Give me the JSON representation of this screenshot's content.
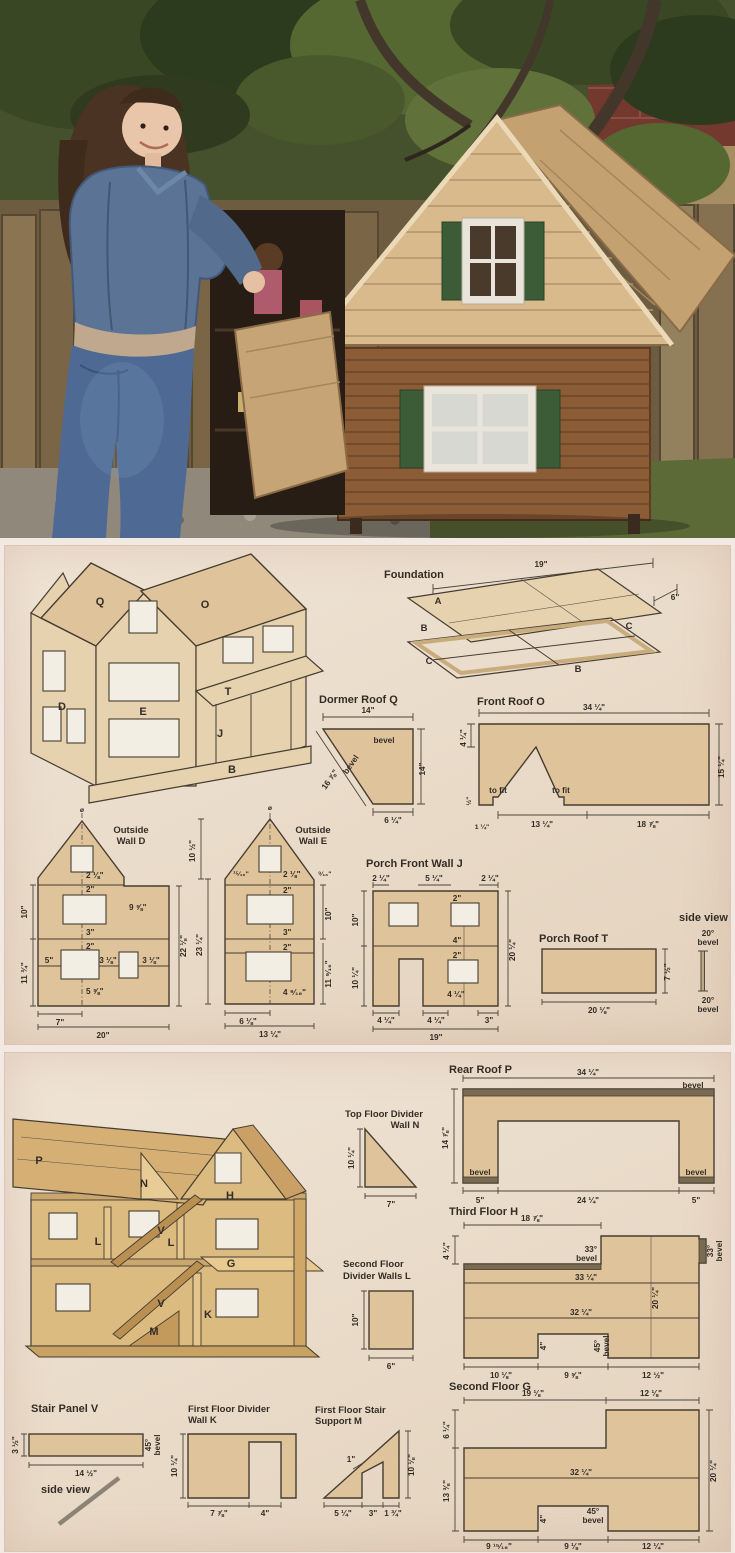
{
  "colors": {
    "wood": "#dfc49b",
    "outline": "#453d31",
    "panel_bg": "#eadcca",
    "roof_shingle": "#d8ba8c",
    "house_wood": "#8c5c37",
    "shutter_green": "#3c5c38",
    "denim": "#5b7495"
  },
  "middle": {
    "house": {
      "q": "Q",
      "o": "O",
      "d": "D",
      "e": "E",
      "t": "T",
      "j": "J",
      "b": "B"
    },
    "foundation": {
      "title": "Foundation",
      "a": "A",
      "b1": "B",
      "c1": "C",
      "c2": "C",
      "b2": "B",
      "w": "19\"",
      "d": "6\""
    },
    "dormer": {
      "title": "Dormer Roof Q",
      "top": "14\"",
      "bevel1": "bevel",
      "bevel2": "bevel",
      "diag": "16 ⅞\"",
      "right": "14\"",
      "bottom": "6 ¼\""
    },
    "front_roof": {
      "title": "Front Roof O",
      "top": "34 ¼\"",
      "left": "4 ¼\"",
      "right": "15 ¼\"",
      "tofit1": "to fit",
      "tofit2": "to fit",
      "half": "½\"",
      "oneq": "1 ¼\"",
      "b1": "13 ¼\"",
      "b2": "18 ⅞\""
    },
    "wall_d": {
      "title1": "Outside",
      "title2": "Wall D",
      "phi": "ø",
      "a1": "2 ⅛\"",
      "a2": "2\"",
      "a3": "9 ⅝\"",
      "a4": "3\"",
      "a5": "2\"",
      "a6": "5\"",
      "a7": "3 ⅛\"",
      "a8": "3 ⅛\"",
      "a9": "5 ⅝\"",
      "l1": "10\"",
      "l2": "11 ¾\"",
      "r1": "22 ⅛\"",
      "b1": "7\"",
      "b2": "20\""
    },
    "wall_e": {
      "title1": "Outside",
      "title2": "Wall E",
      "phi": "ø",
      "l1": "10 ½\"",
      "a1": "¹⁵⁄₁₆\"",
      "a2": "2 ⅛\"",
      "a3": "⁹⁄₁₆\"",
      "a4": "2\"",
      "r1": "10\"",
      "a5": "3\"",
      "a6": "2\"",
      "r2": "11 ⁹⁄₁₆\"",
      "a7": "4 ⁹⁄₁₆\"",
      "l2": "23 ¼\"",
      "b1": "6 ⅛\"",
      "b2": "13 ¼\""
    },
    "wall_j": {
      "title": "Porch Front Wall J",
      "t1": "2 ¼\"",
      "t2": "5 ¼\"",
      "t3": "2 ¼\"",
      "l1": "10\"",
      "l2": "10 ¼\"",
      "r1": "20 ¼\"",
      "a1": "2\"",
      "a2": "4\"",
      "a3": "2\"",
      "a4": "4 ¼\"",
      "b1": "4 ¼\"",
      "b2": "4 ¼\"",
      "b3": "3\"",
      "b4": "19\""
    },
    "porch_roof": {
      "title": "Porch Roof T",
      "b": "20 ⅛\"",
      "r": "7 ½\""
    },
    "side_view": {
      "title": "side view",
      "top1": "20°",
      "top2": "bevel",
      "bot1": "20°",
      "bot2": "bevel"
    }
  },
  "bottom": {
    "house": {
      "p": "P",
      "n": "N",
      "h": "H",
      "l1": "L",
      "l2": "L",
      "g": "G",
      "v1": "V",
      "v2": "V",
      "k": "K",
      "m": "M"
    },
    "rear_roof": {
      "title": "Rear Roof P",
      "top": "34 ¼\"",
      "left": "14 ⅞\"",
      "bevel1": "bevel",
      "bevel2": "bevel",
      "bevel3": "bevel",
      "b1": "5\"",
      "b2": "24 ¼\"",
      "b3": "5\""
    },
    "divider_n": {
      "title1": "Top Floor Divider",
      "title2": "Wall N",
      "l": "10 ¼\"",
      "b": "7\""
    },
    "third_floor": {
      "title": "Third Floor H",
      "top": "18 ⅞\"",
      "left": "4 ¼\"",
      "bev33a1": "33°",
      "bev33a2": "bevel",
      "bev33b1": "33°",
      "bev33b2": "bevel",
      "m1": "33 ¼\"",
      "r": "20 ¼\"",
      "m2": "32 ¼\"",
      "notch": "4\"",
      "bev451": "45°",
      "bev452": "bevel",
      "b1": "10 ⅛\"",
      "b2": "9 ⅝\"",
      "b3": "12 ½\""
    },
    "divider_l": {
      "title1": "Second Floor",
      "title2": "Divider Walls L",
      "l": "10\"",
      "b": "6\""
    },
    "second_floor": {
      "title": "Second Floor G",
      "t1": "19 ⅛\"",
      "t2": "12 ⅛\"",
      "l1": "6 ¼\"",
      "l2": "13 ⅜\"",
      "m1": "32 ¼\"",
      "r": "20 ¼\"",
      "notch": "4\"",
      "bev451": "45°",
      "bev452": "bevel",
      "b1": "9 ¹⁵⁄₁₆\"",
      "b2": "9 ⅛\"",
      "b3": "12 ¼\""
    },
    "stair_v": {
      "title": "Stair Panel V",
      "l": "3 ½\"",
      "b": "14 ½\"",
      "bev1": "45°",
      "bev2": "bevel"
    },
    "side_view": {
      "title": "side view"
    },
    "divider_k": {
      "title1": "First Floor Divider",
      "title2": "Wall K",
      "l": "10 ¼\"",
      "b1": "7 ⅞\"",
      "b2": "4\""
    },
    "stair_m": {
      "title1": "First Floor Stair",
      "title2": "Support M",
      "gap": "1\"",
      "r": "10 ⅛\"",
      "b1": "5 ¼\"",
      "b2": "3\"",
      "b3": "1 ¾\""
    }
  }
}
